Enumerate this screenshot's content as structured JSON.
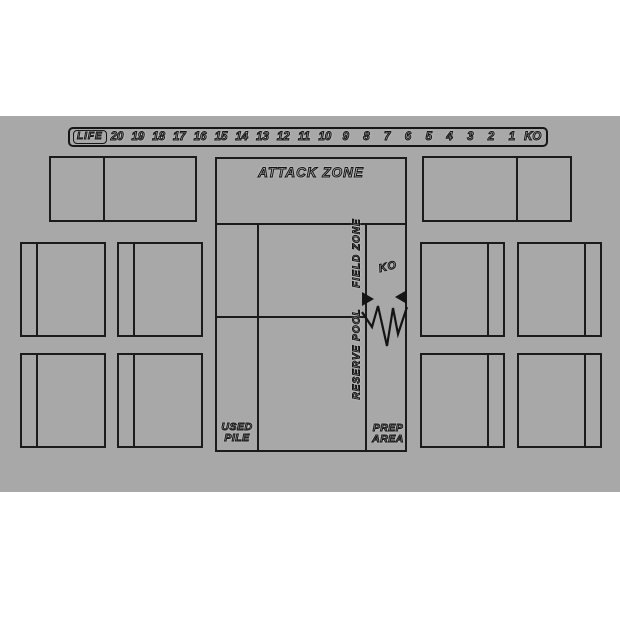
{
  "page": {
    "background": "#ffffff"
  },
  "mat": {
    "background": "#a8a8a8",
    "line_color": "#1b1b1b"
  },
  "life_track": {
    "label": "LIFE",
    "values": [
      "20",
      "19",
      "18",
      "17",
      "16",
      "15",
      "14",
      "13",
      "12",
      "11",
      "10",
      "9",
      "8",
      "7",
      "6",
      "5",
      "4",
      "3",
      "2",
      "1",
      "KO"
    ]
  },
  "zones": {
    "attack_zone": "ATTACK ZONE",
    "field_zone": "FIELD ZONE",
    "reserve_pool": "RESERVE POOL",
    "ko": "KO",
    "used_pile": [
      "USED",
      "PILE"
    ],
    "prep_area": [
      "PREP",
      "AREA"
    ]
  }
}
